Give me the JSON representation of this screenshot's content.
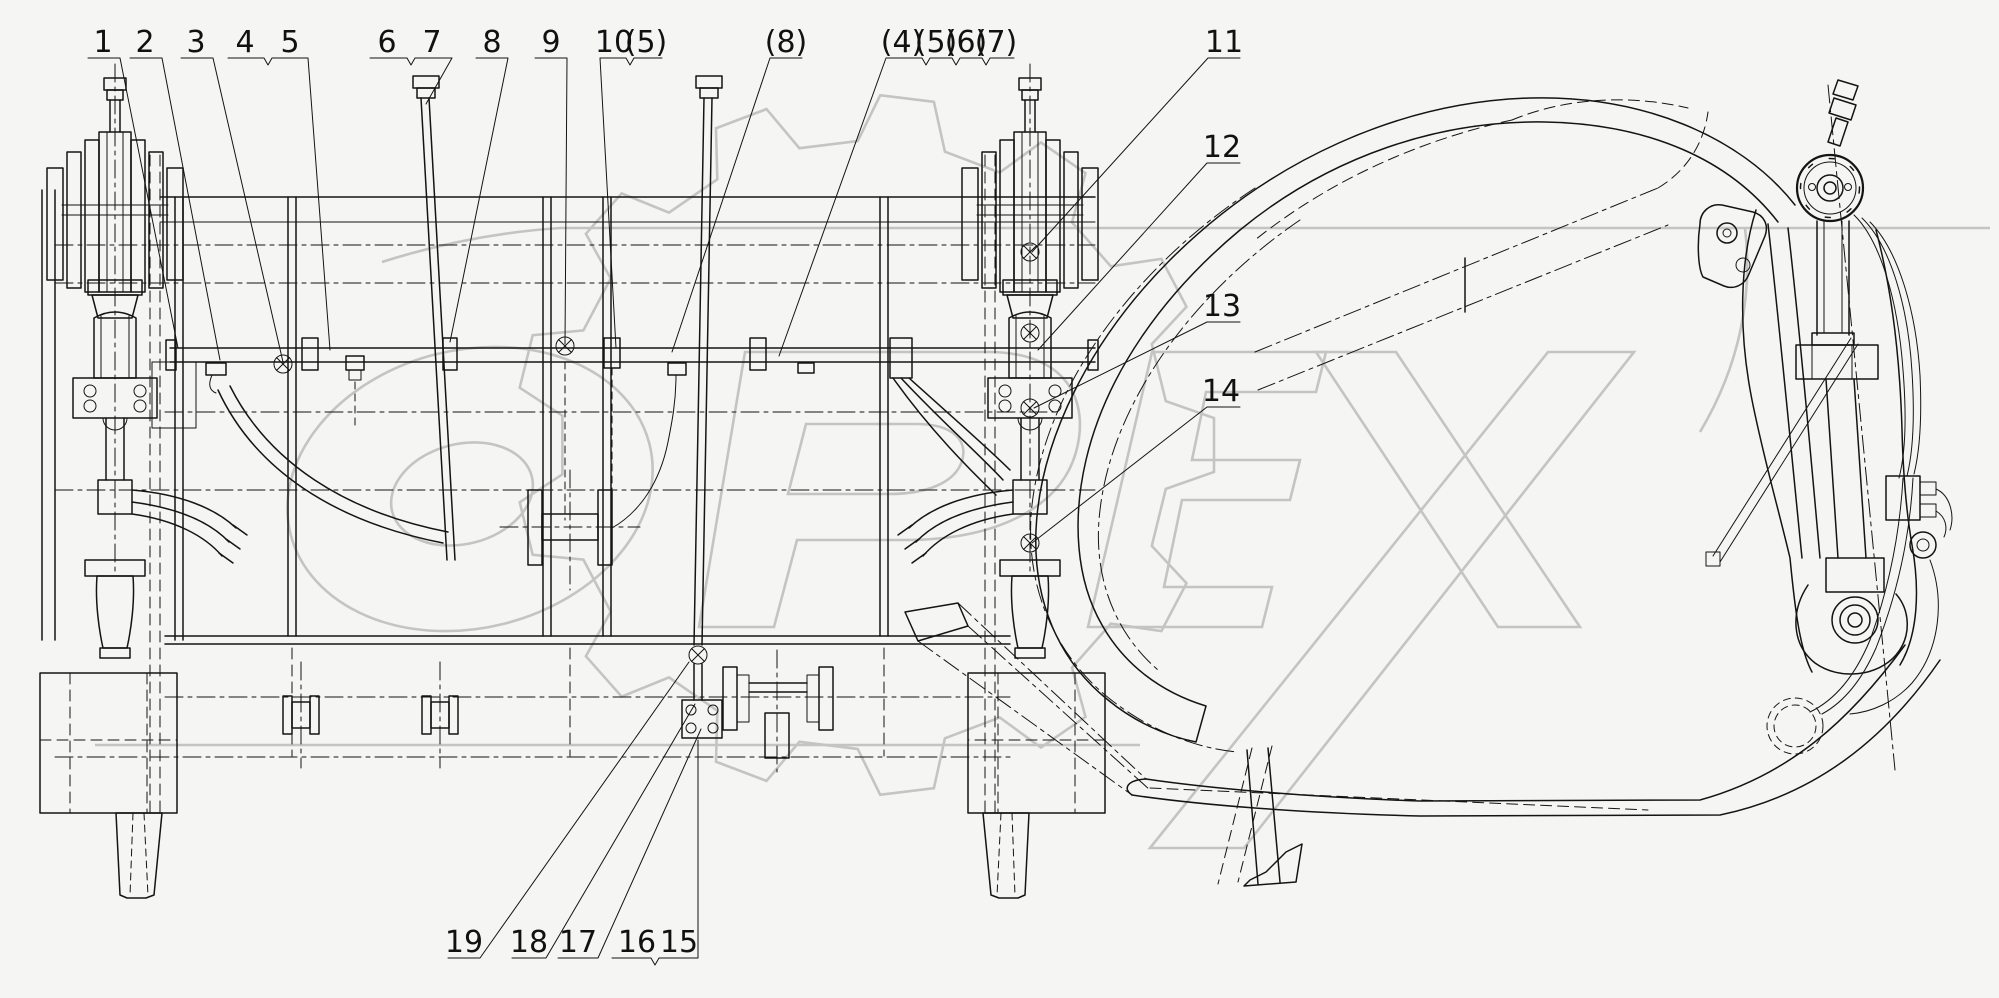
{
  "page": {
    "background": "#f5f5f3",
    "line_color": "#141414",
    "watermark_color": "#c4c4c4"
  },
  "figure": {
    "description": "Engineering parts drawing of a hydraulic log-grapple fork attachment: front view at left, side view of curved grapple at right, with numbered part callouts",
    "views": [
      "front-view",
      "side-view"
    ]
  },
  "watermark": {
    "text": "OPEX"
  },
  "callouts": {
    "font_size": 30,
    "labels": [
      {
        "text": "1",
        "x": 103,
        "y": 52
      },
      {
        "text": "2",
        "x": 145,
        "y": 52
      },
      {
        "text": "3",
        "x": 196,
        "y": 52
      },
      {
        "text": "4",
        "x": 245,
        "y": 52
      },
      {
        "text": "5",
        "x": 290,
        "y": 52
      },
      {
        "text": "6",
        "x": 387,
        "y": 52
      },
      {
        "text": "7",
        "x": 432,
        "y": 52
      },
      {
        "text": "8",
        "x": 492,
        "y": 52
      },
      {
        "text": "9",
        "x": 551,
        "y": 52
      },
      {
        "text": "10",
        "x": 614,
        "y": 52
      },
      {
        "text": "(5)",
        "x": 646,
        "y": 52
      },
      {
        "text": "(8)",
        "x": 786,
        "y": 52
      },
      {
        "text": "(4)",
        "x": 902,
        "y": 52
      },
      {
        "text": "(5)",
        "x": 936,
        "y": 52
      },
      {
        "text": "(6)",
        "x": 966,
        "y": 52
      },
      {
        "text": "(7)",
        "x": 996,
        "y": 52
      },
      {
        "text": "11",
        "x": 1224,
        "y": 52
      },
      {
        "text": "12",
        "x": 1222,
        "y": 157
      },
      {
        "text": "13",
        "x": 1222,
        "y": 316
      },
      {
        "text": "14",
        "x": 1221,
        "y": 401
      },
      {
        "text": "19",
        "x": 464,
        "y": 952
      },
      {
        "text": "18",
        "x": 529,
        "y": 952
      },
      {
        "text": "17",
        "x": 578,
        "y": 952
      },
      {
        "text": "16",
        "x": 637,
        "y": 952
      },
      {
        "text": "15",
        "x": 679,
        "y": 952
      }
    ],
    "leaders": [
      {
        "points": [
          [
            88,
            58
          ],
          [
            120,
            58
          ],
          [
            178,
            348
          ]
        ]
      },
      {
        "points": [
          [
            130,
            58
          ],
          [
            162,
            58
          ],
          [
            220,
            360
          ]
        ]
      },
      {
        "points": [
          [
            181,
            58
          ],
          [
            213,
            58
          ],
          [
            283,
            362
          ]
        ]
      },
      {
        "points": [
          [
            228,
            58
          ],
          [
            264,
            58
          ],
          [
            268,
            65
          ],
          [
            272,
            58
          ],
          [
            308,
            58
          ],
          [
            330,
            350
          ]
        ]
      },
      {
        "points": [
          [
            370,
            58
          ],
          [
            407,
            58
          ],
          [
            411,
            65
          ],
          [
            415,
            58
          ],
          [
            452,
            58
          ],
          [
            426,
            104
          ]
        ]
      },
      {
        "points": [
          [
            476,
            58
          ],
          [
            508,
            58
          ],
          [
            450,
            342
          ]
        ]
      },
      {
        "points": [
          [
            535,
            58
          ],
          [
            567,
            58
          ],
          [
            565,
            344
          ]
        ]
      },
      {
        "points": [
          [
            662,
            58
          ],
          [
            634,
            58
          ],
          [
            630,
            65
          ],
          [
            626,
            58
          ],
          [
            600,
            58
          ],
          [
            616,
            348
          ]
        ]
      },
      {
        "points": [
          [
            802,
            58
          ],
          [
            770,
            58
          ],
          [
            672,
            352
          ]
        ]
      },
      {
        "points": [
          [
            1014,
            58
          ],
          [
            990,
            58
          ],
          [
            986,
            65
          ],
          [
            982,
            58
          ],
          [
            960,
            58
          ],
          [
            956,
            65
          ],
          [
            952,
            58
          ],
          [
            930,
            58
          ],
          [
            926,
            65
          ],
          [
            922,
            58
          ],
          [
            886,
            58
          ],
          [
            779,
            356
          ]
        ]
      },
      {
        "points": [
          [
            1240,
            58
          ],
          [
            1208,
            58
          ],
          [
            1032,
            252
          ]
        ]
      },
      {
        "points": [
          [
            1240,
            163
          ],
          [
            1207,
            163
          ],
          [
            1038,
            350
          ]
        ]
      },
      {
        "points": [
          [
            1240,
            322
          ],
          [
            1207,
            322
          ],
          [
            1034,
            408
          ]
        ]
      },
      {
        "points": [
          [
            1240,
            407
          ],
          [
            1207,
            407
          ],
          [
            1032,
            543
          ]
        ]
      },
      {
        "points": [
          [
            448,
            958
          ],
          [
            480,
            958
          ],
          [
            689,
            662
          ]
        ]
      },
      {
        "points": [
          [
            512,
            958
          ],
          [
            546,
            958
          ],
          [
            695,
            704
          ]
        ]
      },
      {
        "points": [
          [
            558,
            958
          ],
          [
            598,
            958
          ],
          [
            701,
            729
          ]
        ]
      },
      {
        "points": [
          [
            612,
            958
          ],
          [
            651,
            958
          ],
          [
            655,
            965
          ],
          [
            659,
            958
          ],
          [
            698,
            958
          ],
          [
            698,
            740
          ]
        ]
      }
    ],
    "markers": [
      {
        "x": 283,
        "y": 364
      },
      {
        "x": 565,
        "y": 346
      },
      {
        "x": 698,
        "y": 655
      },
      {
        "x": 1030,
        "y": 252
      },
      {
        "x": 1030,
        "y": 333
      },
      {
        "x": 1030,
        "y": 408
      },
      {
        "x": 1030,
        "y": 543
      }
    ]
  }
}
